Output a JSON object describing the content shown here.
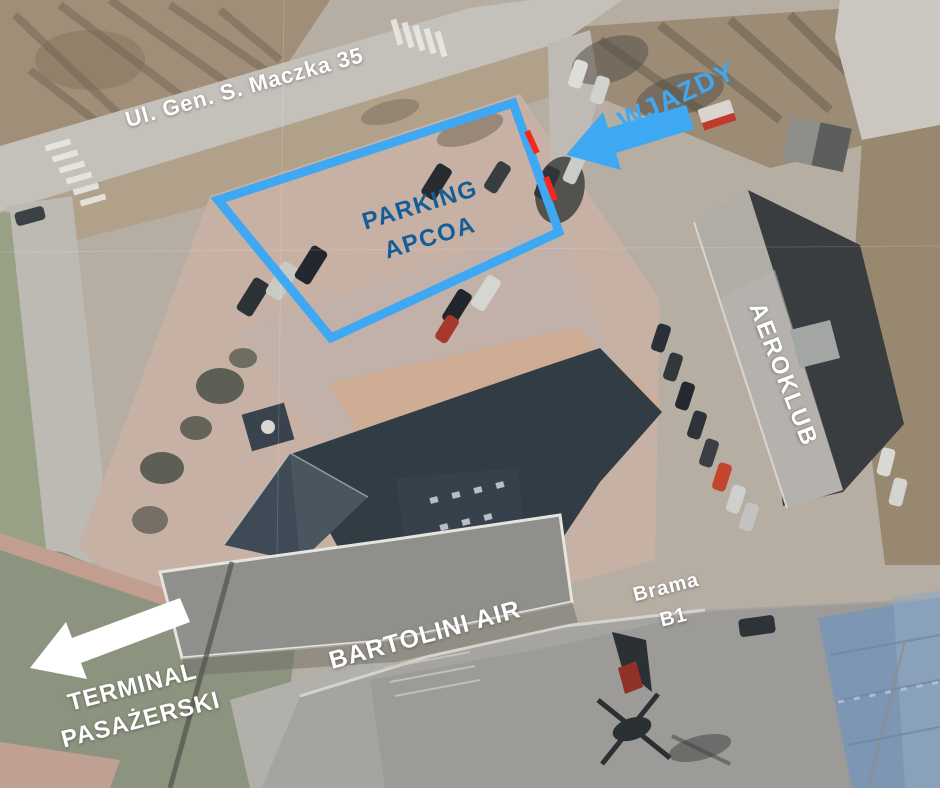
{
  "labels": {
    "street": "Ul. Gen. S. Maczka 35",
    "entrances": "WJAZDY",
    "parking_line1": "PARKING",
    "parking_line2": "APCOA",
    "aeroklub": "AEROKLUB",
    "bartolini": "BARTOLINI AIR",
    "gate_line1": "Brama",
    "gate_line2": "B1",
    "terminal_line1": "TERMINAL",
    "terminal_line2": "PASAŻERSKI"
  },
  "colors": {
    "annotation_blue": "#3FA8F2",
    "parking_text_blue": "#145E97",
    "entrance_dash_red": "#F5281B",
    "label_white": "#FFFFFF"
  }
}
